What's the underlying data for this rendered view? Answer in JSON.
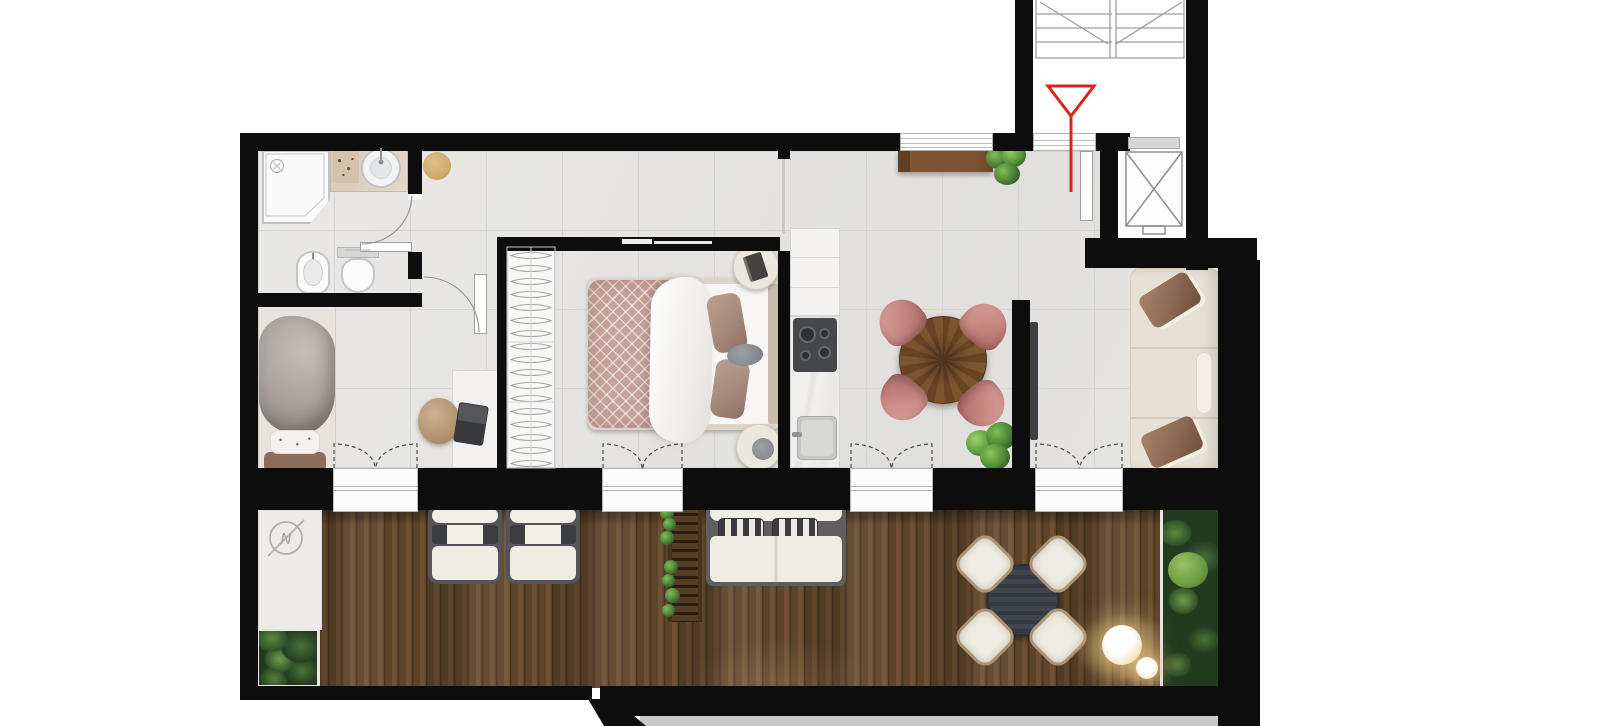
{
  "meta": {
    "type": "architectural-floor-plan",
    "view": "top-down-3d-render",
    "subject": "apartment with wrap terrace, stair core and elevator"
  },
  "palette": {
    "wall": "#0d0d0d",
    "floor_tile": "#e5e4e1",
    "tile_line": "#d7d5d1",
    "deck_dark": "#4a3521",
    "deck_mid": "#5d4529",
    "deck_light": "#6e5233",
    "paving": "#ecebe8",
    "accent_red": "#d7261d",
    "line_gray": "#9e9e9e",
    "frame_gray": "#54555a",
    "cream_sofa": "#e7e1d5",
    "pillow_brown": "#8a6853",
    "chair_pink": "#c98b86",
    "chair_pink_dark": "#a96762",
    "wood": "#7c5431",
    "wood_dark": "#5f3e22",
    "plant_dark": "#2e4a28",
    "plant_mid": "#4a6b35",
    "plant_light": "#6fa14e",
    "quilt_pink": "#c8a29a",
    "taupe_pillow": "#a5897b",
    "marble": "#f1efec",
    "cooktop": "#46474b",
    "outdoor_table": "#41454d",
    "stool_tan": "#cfab72",
    "lamp_glow": "#e8c77f",
    "sill_gray": "#d6d6d6"
  },
  "compass": {
    "letter": "N"
  },
  "floorplan": {
    "rooms": [
      {
        "name": "bathroom",
        "furniture": [
          "shower",
          "washbasin-vanity",
          "bidet",
          "toilet"
        ]
      },
      {
        "name": "bedroom-2",
        "furniture": [
          "single-bed",
          "desk",
          "desk-chair"
        ]
      },
      {
        "name": "hallway",
        "furniture": [
          "round-stool"
        ]
      },
      {
        "name": "master-bedroom",
        "furniture": [
          "wardrobe-with-hangers",
          "double-bed",
          "nightstand",
          "nightstand"
        ]
      },
      {
        "name": "kitchen",
        "furniture": [
          "tall-cabinet",
          "cooktop",
          "counter",
          "sink"
        ]
      },
      {
        "name": "living-dining-room",
        "furniture": [
          "sideboard",
          "plant",
          "round-dining-table",
          "dining-chair",
          "dining-chair",
          "dining-chair",
          "dining-chair",
          "tv-partition",
          "sofa",
          "floor-plant"
        ]
      },
      {
        "name": "entrance",
        "furniture": [
          "entrance-door",
          "threshold"
        ]
      },
      {
        "name": "stair-core",
        "furniture": [
          "staircase",
          "elevator"
        ]
      },
      {
        "name": "terrace",
        "furniture": [
          "compass-mark",
          "planter",
          "planter",
          "sun-lounger",
          "sun-lounger",
          "plant-trellis",
          "outdoor-sofa",
          "outdoor-dining-table",
          "outdoor-chair",
          "outdoor-chair",
          "outdoor-chair",
          "outdoor-chair",
          "floor-lamp",
          "floor-lamp"
        ]
      }
    ],
    "annotations": [
      "entrance-arrow-red",
      "north-compass"
    ]
  }
}
